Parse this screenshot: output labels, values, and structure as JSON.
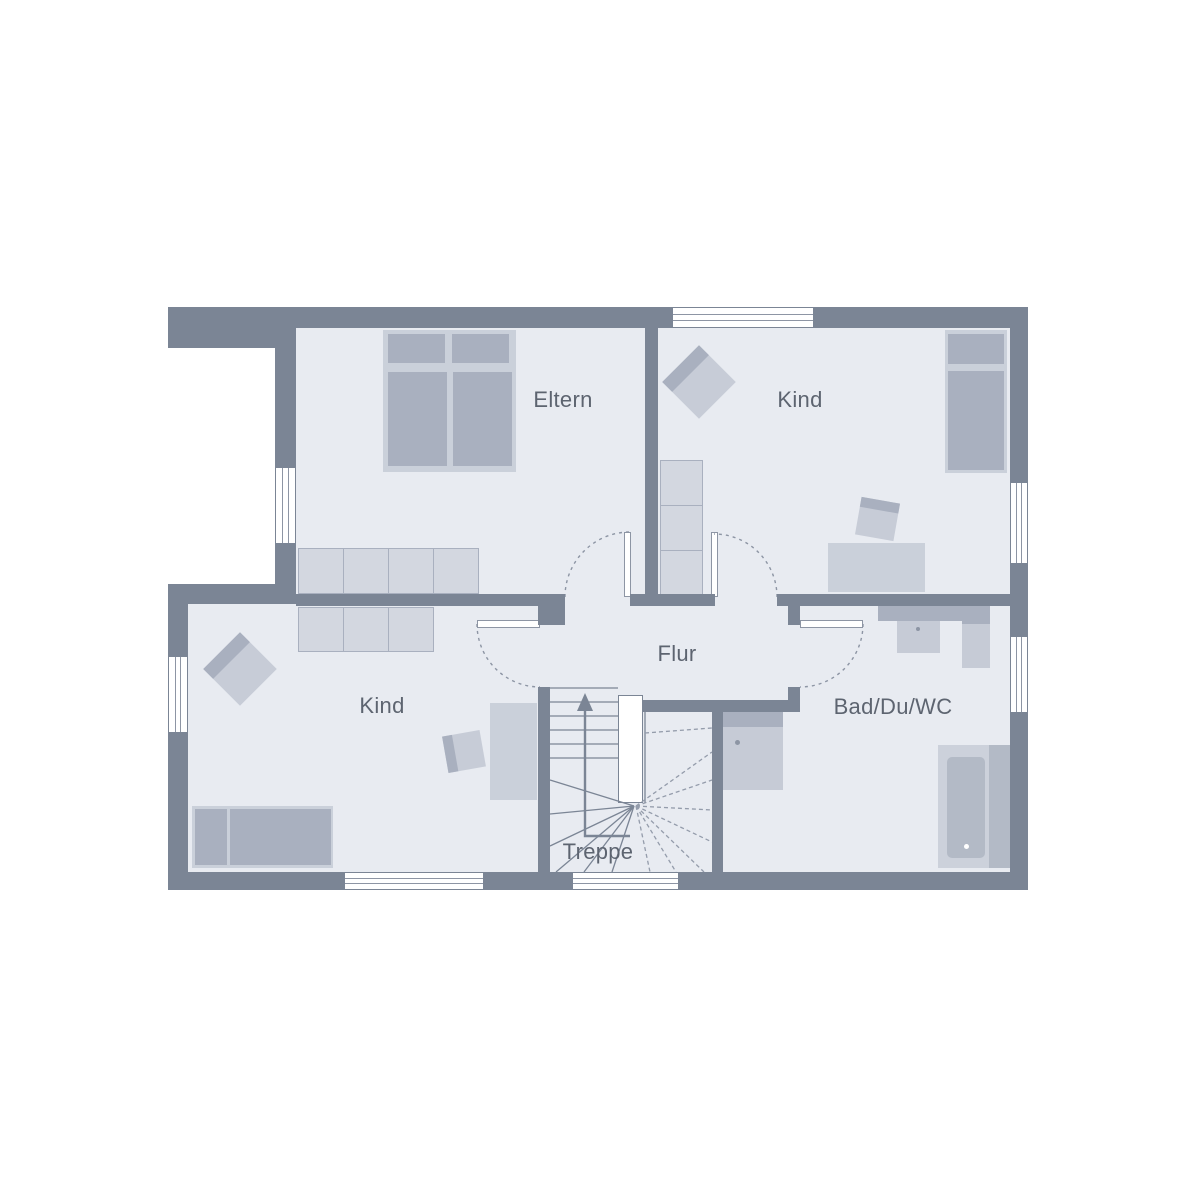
{
  "floorplan": {
    "type": "residential-floor-plan",
    "rooms": [
      {
        "id": "eltern",
        "label": "Eltern"
      },
      {
        "id": "kind-top-right",
        "label": "Kind"
      },
      {
        "id": "kind-bottom-left",
        "label": "Kind"
      },
      {
        "id": "flur",
        "label": "Flur"
      },
      {
        "id": "bad-du-wc",
        "label": "Bad/Du/WC"
      },
      {
        "id": "treppe",
        "label": "Treppe"
      }
    ],
    "stair_direction": "up",
    "colors": {
      "wall": "#7b8595",
      "floor": "#e8ebf1",
      "furniture_light": "#cad0da",
      "furniture_medium": "#a9b0bf",
      "wardrobe_fill": "#d3d7e0",
      "fixture_light": "#c6cbd6",
      "line": "#8d95a4",
      "text": "#5d6470",
      "background": "#ffffff"
    }
  }
}
